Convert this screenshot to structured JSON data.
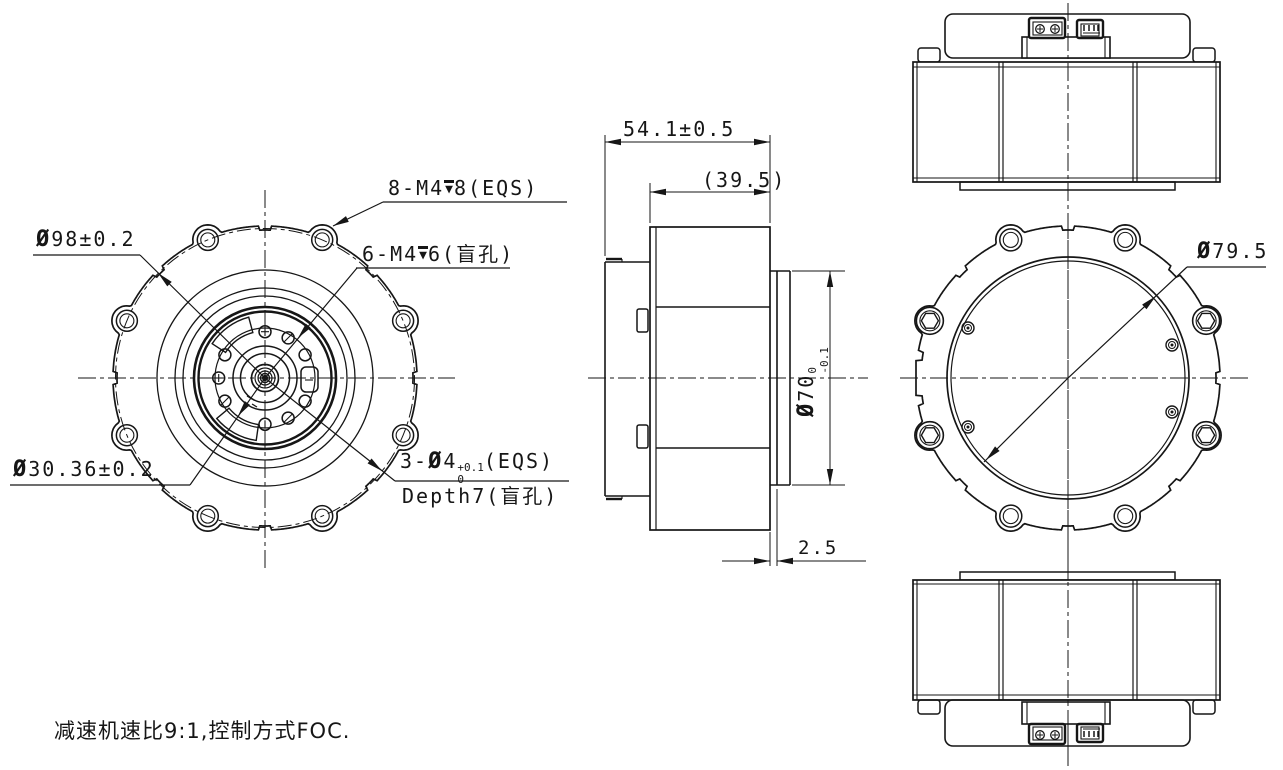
{
  "note": "减速机速比9:1,控制方式FOC.",
  "front_view": {
    "callout_outer_holes": {
      "prefix": "8-M4",
      "depth_symbol": "▼",
      "suffix": "8(EQS)"
    },
    "callout_face_holes": {
      "prefix": "6-M4",
      "depth_symbol": "▼",
      "suffix": "6(盲孔)"
    },
    "dim_flange_diameter": {
      "symbol": "Ø",
      "text": "98±0.2"
    },
    "dim_hole_circle_diameter": {
      "symbol": "Ø",
      "text": "30.36±0.2"
    },
    "callout_pin_holes": {
      "prefix": "3-",
      "symbol": "Ø",
      "size": "4",
      "tol_upper": "+0.1",
      "tol_lower": "0",
      "suffix": "(EQS)",
      "line2": "Depth7(盲孔)"
    }
  },
  "side_view": {
    "dim_overall_length": "54.1±0.5",
    "dim_body_length": "(39.5)",
    "dim_pilot_diameter": {
      "symbol": "Ø",
      "size": "70",
      "tol_upper": "0",
      "tol_lower": "-0.1"
    },
    "dim_flange_thickness": "2.5"
  },
  "back_view": {
    "dim_rotor_diameter": {
      "symbol": "Ø",
      "text": "79.5"
    }
  }
}
